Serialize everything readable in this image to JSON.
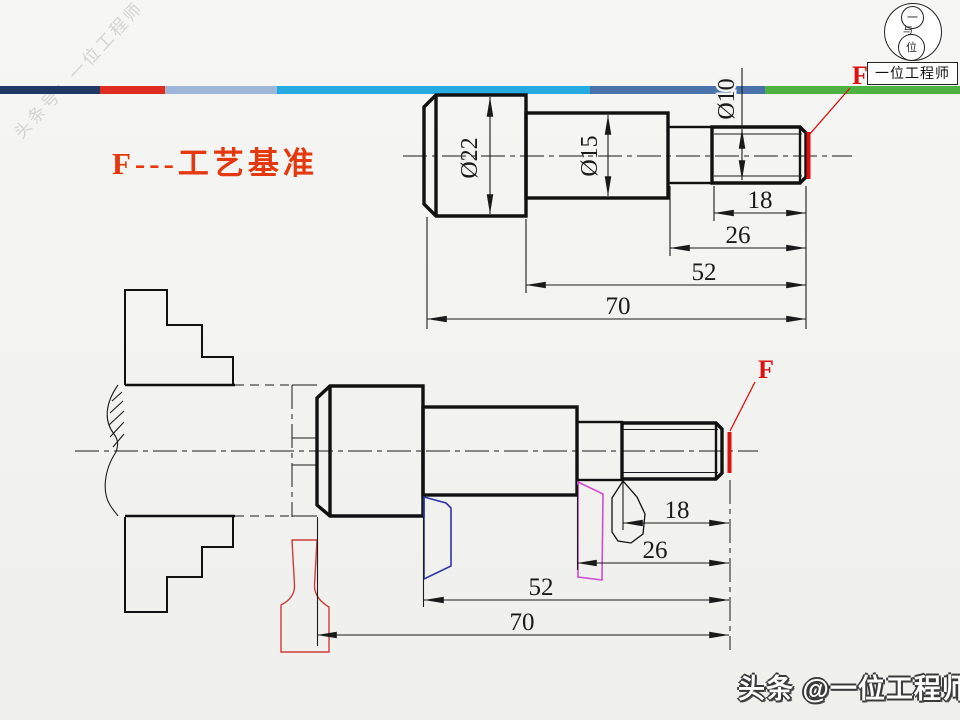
{
  "slide": {
    "watermark": "头条号：一位工程师",
    "title": "F---工艺基准",
    "footer": "头条 @一位工程师"
  },
  "logo": {
    "top_char": "一",
    "mid_char": "与",
    "bottom_char": "位",
    "label": "一位工程师"
  },
  "colors": {
    "bar_navy": "#203864",
    "bar_red": "#e02b20",
    "bar_bluegray": "#9fb6d8",
    "bar_cyan": "#25aae1",
    "bar_steel": "#4a73ab",
    "bar_green": "#4db241",
    "title_red": "#e5380e",
    "datum_red": "#dd1111",
    "tool_blue": "#2a35a8",
    "tool_magenta": "#cf4ed0",
    "tool_red": "#d03a3a"
  },
  "top_drawing": {
    "dia_head": "Ø22",
    "dia_middle": "Ø15",
    "dia_thread": "Ø10",
    "dim_18": "18",
    "dim_26": "26",
    "dim_52": "52",
    "dim_70": "70",
    "datum": "F"
  },
  "bottom_drawing": {
    "dim_18": "18",
    "dim_26": "26",
    "dim_52": "52",
    "dim_70": "70",
    "datum": "F"
  }
}
